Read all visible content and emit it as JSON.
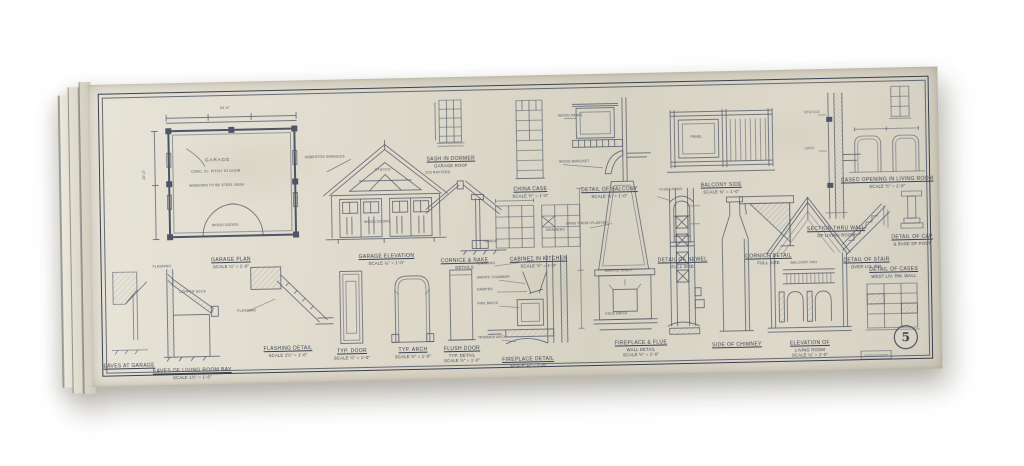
{
  "sheet": {
    "number": "5"
  },
  "colors": {
    "ink": "#4d5566",
    "paper": "#ddd9cb"
  },
  "figures": {
    "garage_plan": {
      "caption": [
        "GARAGE PLAN",
        "SCALE ¼\" = 1'-0\""
      ],
      "labels": {
        "room": "GARAGE",
        "floor": "CONC. FL. PITCH TO DOOR",
        "note": "WINDOWS TO BE STEEL SASH",
        "doors": "WOOD DOORS",
        "dim_top": "24'-6\"",
        "dim_side": "20'-0\""
      }
    },
    "garage_elevation": {
      "caption": [
        "GARAGE ELEVATION",
        "SCALE ¼\" = 1'-0\""
      ],
      "labels": {
        "roof": "ASBESTOS SHINGLES",
        "wall": "STUCCO",
        "doors": "WOOD DOORS"
      }
    },
    "dormer_sash": {
      "caption": [
        "SASH IN DORMER",
        "GARAGE ROOF"
      ]
    },
    "rake_detail": {
      "caption": [
        "CORNICE & RAKE",
        "DETAILS"
      ],
      "labels": {
        "rafters": "2x6 RAFTERS",
        "grade": "GRADE"
      }
    },
    "china_case": {
      "caption": [
        "CHINA CASE",
        "SCALE ½\" = 1'-0\""
      ]
    },
    "cabinet_kitchen": {
      "caption": [
        "CABINET IN KITCHEN",
        "SCALE ½\" = 1'-0\""
      ],
      "labels": {
        "drawers": "DRAWERS"
      }
    },
    "balcony_detail": {
      "caption": [
        "DETAIL OF BALCONY",
        "SCALE ¾\" = 1'-0\""
      ],
      "labels": {
        "panel": "WOOD PANEL",
        "bracket": "WOOD BRACKET"
      }
    },
    "balcony_side": {
      "caption": [
        "BALCONY SIDE",
        "SCALE ¾\" = 1'-0\""
      ],
      "labels": {
        "panel": "PANEL"
      }
    },
    "newel_detail": {
      "caption": [
        "DETAIL OF NEWEL",
        "FULL SIZE"
      ]
    },
    "cornice_detail": {
      "caption": [
        "CORNICE DETAIL",
        "FULL SIZE"
      ]
    },
    "wall_section": {
      "caption": [
        "SECTION THRU WALL",
        "OF LIVING ROOM"
      ],
      "labels": {
        "stucco": "STUCCO",
        "lath": "LATH"
      }
    },
    "cased_opening": {
      "caption": [
        "CASED OPENING IN LIVING ROOM",
        "SCALE ½\" = 1'-0\""
      ]
    },
    "garage_eaves": {
      "caption": [
        "EAVES AT GARAGE"
      ]
    },
    "eaves_section": {
      "caption": [
        "EAVES OF LIVING ROOM BAY",
        "SCALE 1½\" = 1'-0\""
      ],
      "labels": {
        "flashing": "FLASHING",
        "deck": "COPPER DECK"
      }
    },
    "flashing_detail": {
      "caption": [
        "FLASHING DETAIL",
        "SCALE 1½\" = 1'-0\""
      ],
      "labels": {
        "flashing": "FLASHING"
      }
    },
    "typ_door": {
      "caption": [
        "TYP. DOOR",
        "SCALE ½\" = 1'-0\""
      ]
    },
    "typ_arch": {
      "caption": [
        "TYP. ARCH",
        "SCALE ½\" = 1'-0\""
      ]
    },
    "flush_door": {
      "caption": [
        "FLUSH DOOR",
        "TYP. DETAIL",
        "SCALE ½\" = 1'-0\""
      ]
    },
    "fireplace_detail": {
      "caption": [
        "FIREPLACE DETAIL",
        "SCALE ¾\" = 1'-0\""
      ],
      "labels": {
        "a": [
          "FLASHING",
          "SMOKE CHAMBER",
          "DAMPER",
          "FIRE BRICK",
          "TRIMMER ARCH"
        ]
      }
    },
    "fireplace_flue": {
      "caption": [
        "FIREPLACE & FLUE",
        "WALL DETAIL",
        "SCALE ½\" = 1'-0\""
      ],
      "labels": {
        "plaster": "SAND FINISH PLASTER",
        "mantel": "MANTEL SHELF",
        "brick": "FACE BRICK",
        "flue": "FLUE LINING"
      }
    },
    "chimney_side": {
      "caption": [
        "SIDE OF CHIMNEY"
      ]
    },
    "living_room": {
      "caption": [
        "ELEVATION OF",
        "LIVING ROOM",
        "SCALE ¼\" = 1'-0\""
      ],
      "labels": {
        "balcony": "BALCONY RAIL"
      }
    },
    "stair_detail": {
      "caption": [
        "DETAIL OF STAIR",
        "OVER LIV. RM."
      ]
    },
    "cap_base": {
      "caption": [
        "DETAIL OF CAP",
        "& BASE OF POST"
      ]
    },
    "bookcases": {
      "caption": [
        "DETAIL OF CASES",
        "WEST LIV. RM. WALL"
      ]
    }
  }
}
